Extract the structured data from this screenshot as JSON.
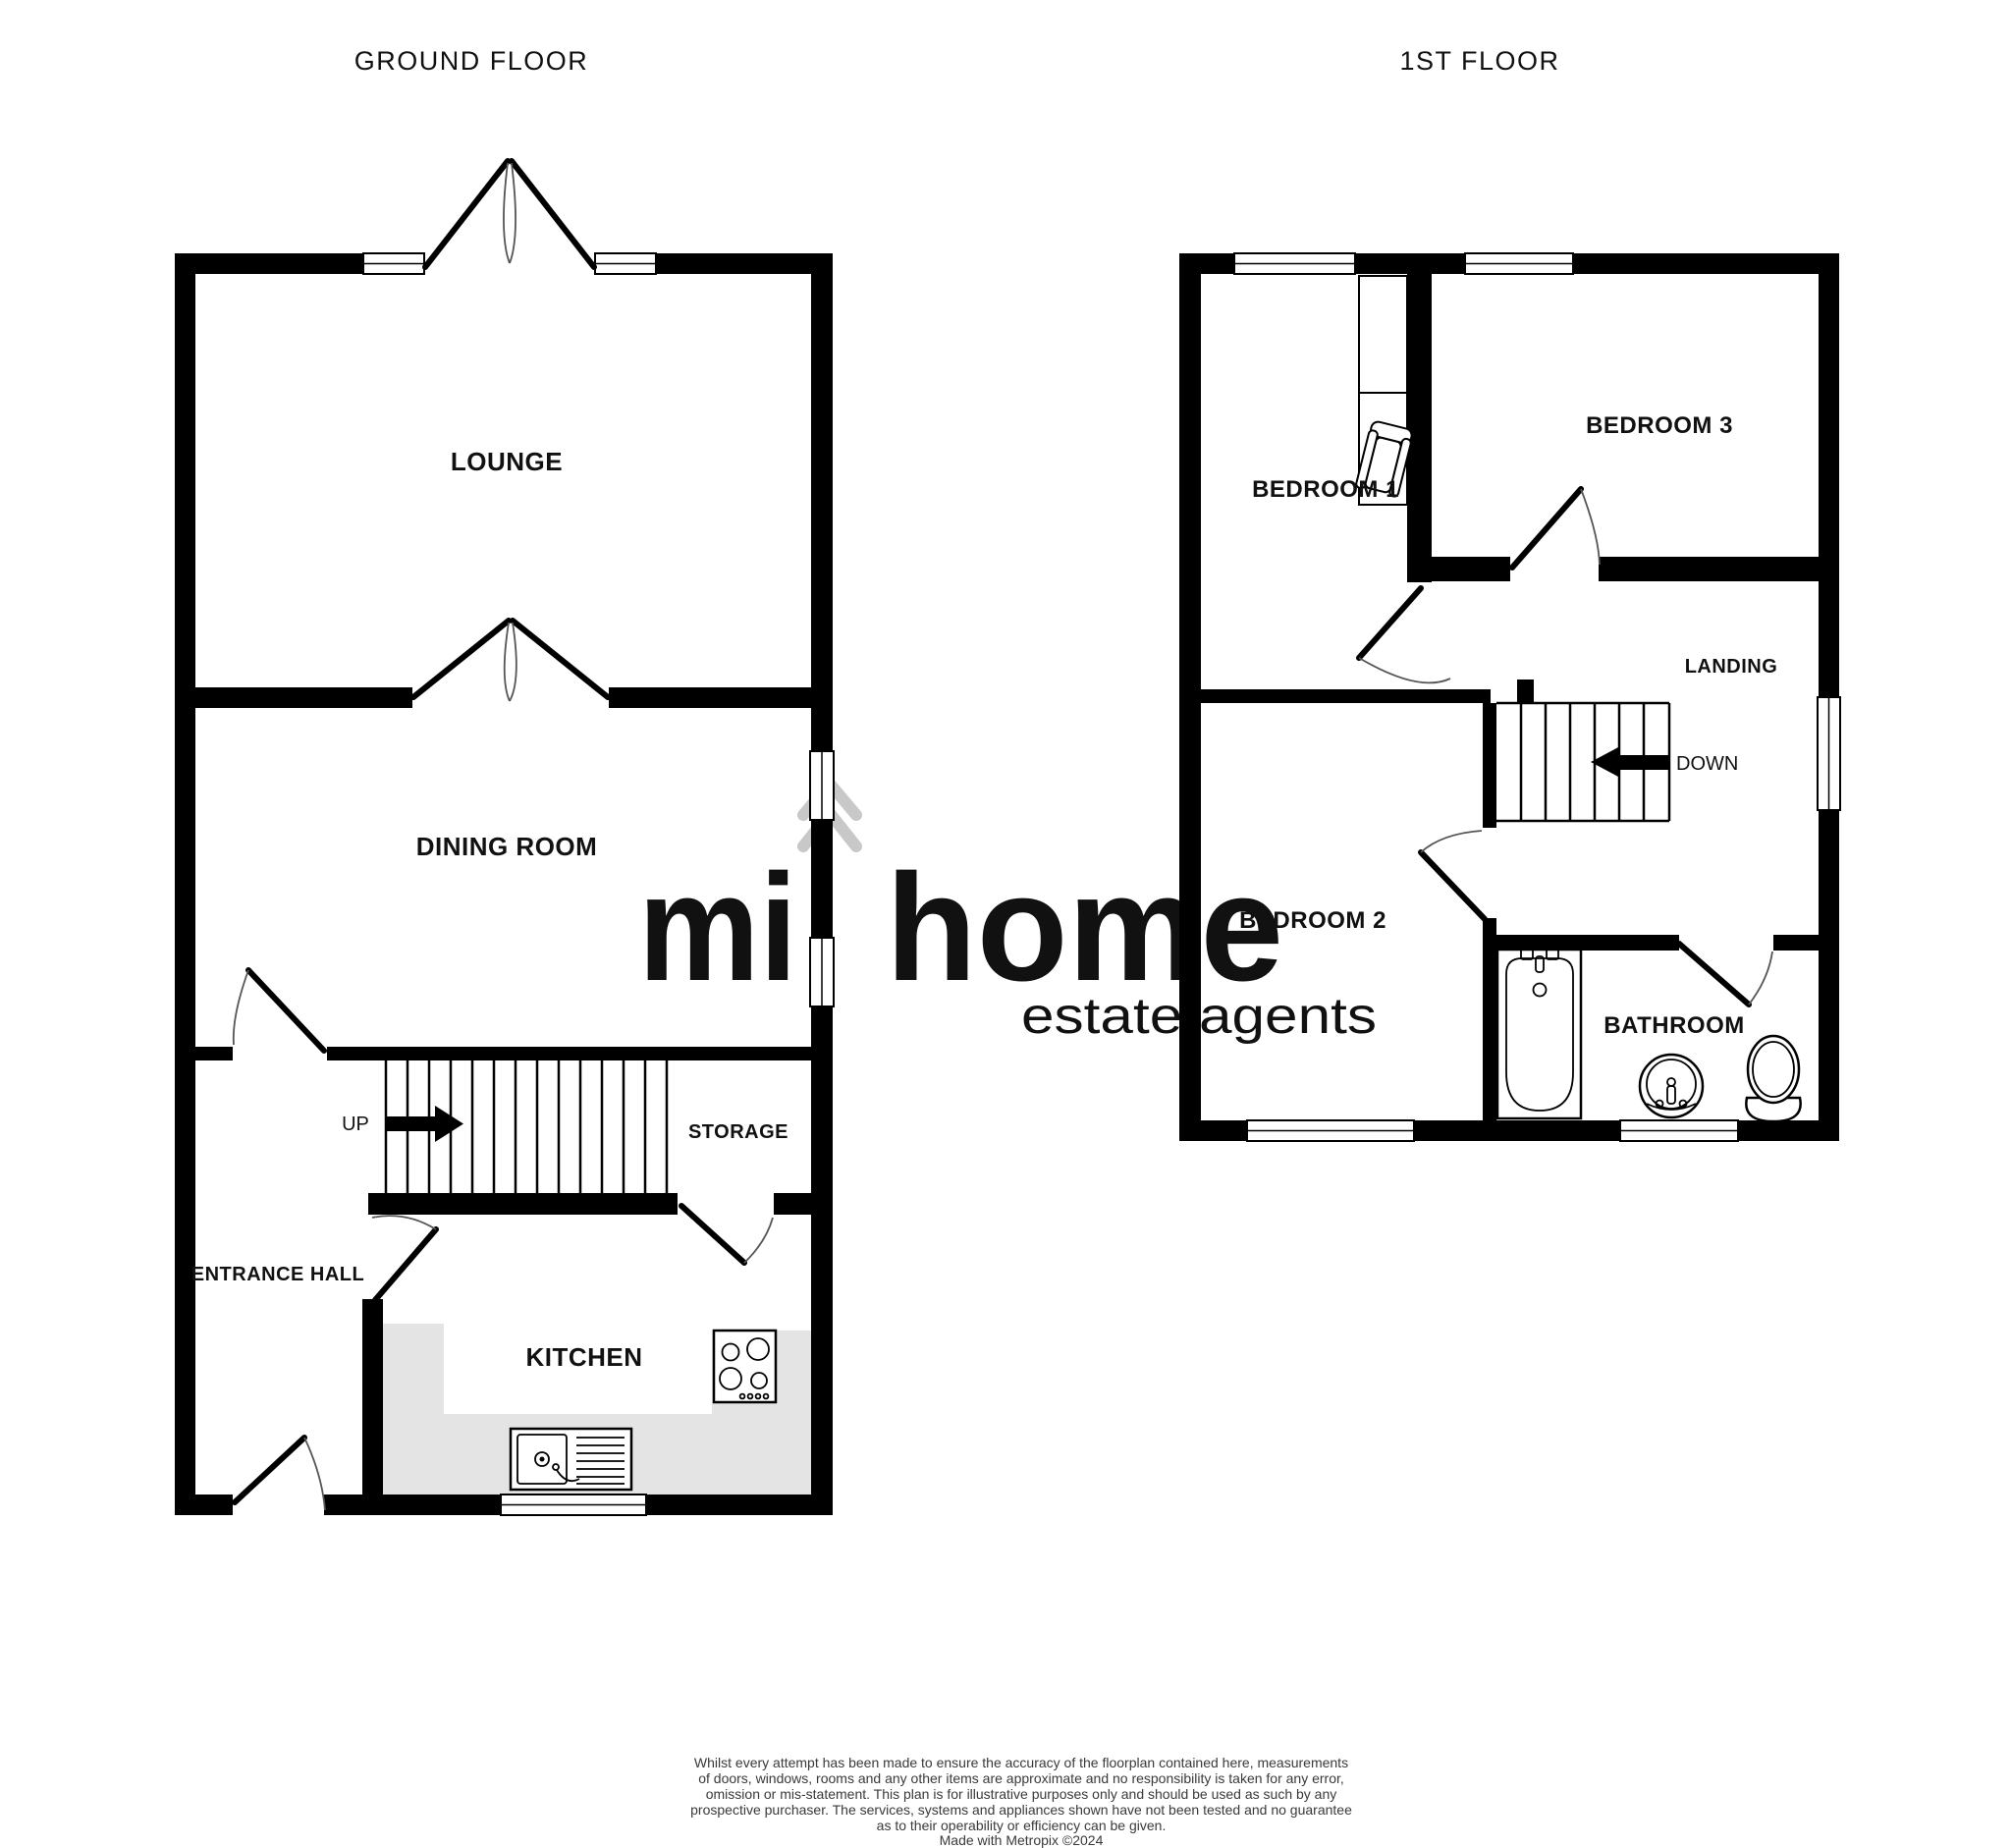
{
  "floorplan": {
    "ground_floor": {
      "title": "GROUND FLOOR",
      "rooms": {
        "lounge": "LOUNGE",
        "dining_room": "DINING ROOM",
        "entrance_hall": "ENTRANCE HALL",
        "kitchen": "KITCHEN",
        "storage": "STORAGE"
      },
      "stairs_direction": "UP"
    },
    "first_floor": {
      "title": "1ST FLOOR",
      "rooms": {
        "bedroom_1": "BEDROOM 1",
        "bedroom_2": "BEDROOM 2",
        "bedroom_3": "BEDROOM 3",
        "landing": "LANDING",
        "bathroom": "BATHROOM"
      },
      "stairs_direction": "DOWN"
    }
  },
  "watermark": {
    "brand_word_1": "mi",
    "brand_word_2": "home",
    "tagline": "estate agents"
  },
  "disclaimer": {
    "lines": [
      "Whilst every attempt has been made to ensure the accuracy of the floorplan contained here, measurements",
      "of doors, windows, rooms and any other items are approximate and no responsibility is taken for any error,",
      "omission or mis-statement. This plan is for illustrative purposes only and should be used as such by any",
      "prospective purchaser. The services, systems and appliances shown have not been tested and no guarantee",
      "as to their operability or efficiency can be given."
    ],
    "credit_line": "Made with Metropix ©2024"
  },
  "colors": {
    "wall": "#000000",
    "counter": "#e4e4e4",
    "watermark": "#c8c8c8",
    "label_text": "#111111",
    "disclaimer_text": "#3a3a3a"
  }
}
